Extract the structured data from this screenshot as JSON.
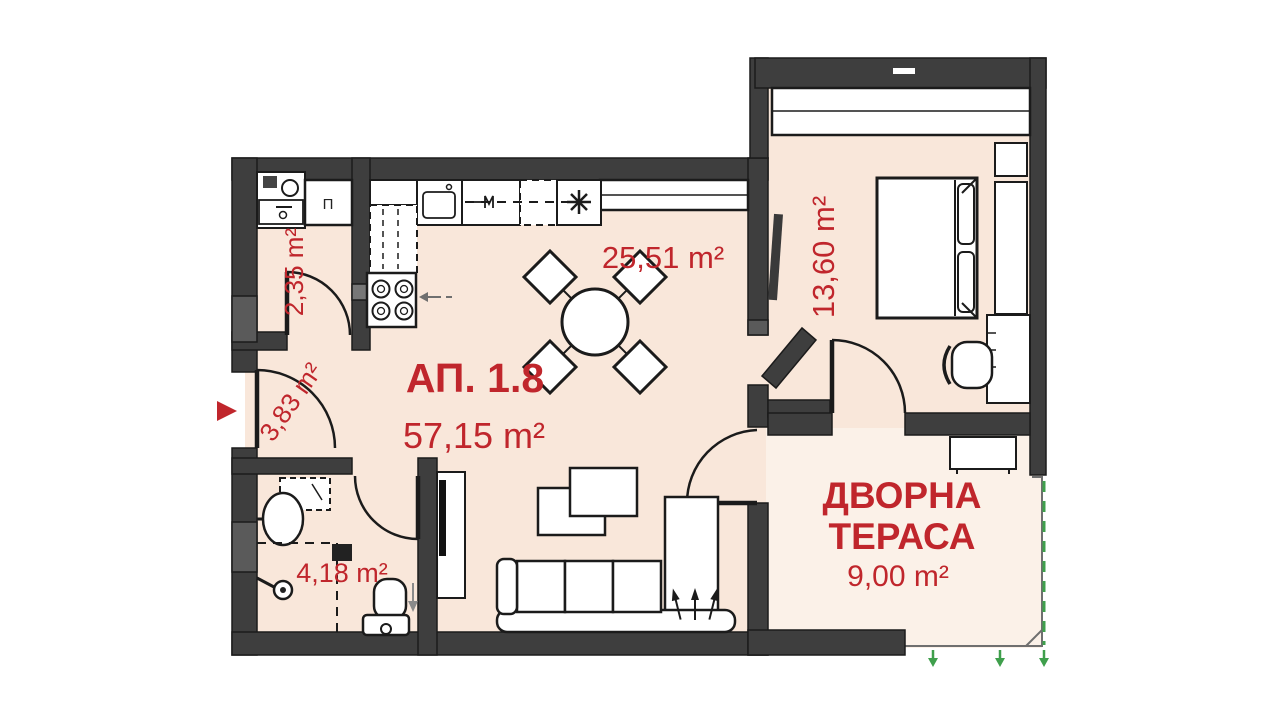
{
  "plan": {
    "apartment_label": "АП. 1.8",
    "apartment_area": "57,15 m²",
    "closet_label": "П",
    "rooms": {
      "living": {
        "area": "25,51 m²"
      },
      "corridor": {
        "area": "2,35 m²"
      },
      "hall": {
        "area": "3,83 m²"
      },
      "bathroom": {
        "area": "4,18 m²"
      },
      "bedroom": {
        "area": "13,60 m²"
      },
      "terrace": {
        "name_line1": "ДВОРНА",
        "name_line2": "ТЕРАСА",
        "area": "9,00 m²"
      }
    },
    "colors": {
      "accent_red": "#c0262c",
      "wall_dark": "#3e3e3e",
      "wall_light": "#5a5a5a",
      "room_fill": "#f9e7da",
      "terrace_fill": "#fbf1e8",
      "garden_green": "#3f9f4c"
    }
  }
}
